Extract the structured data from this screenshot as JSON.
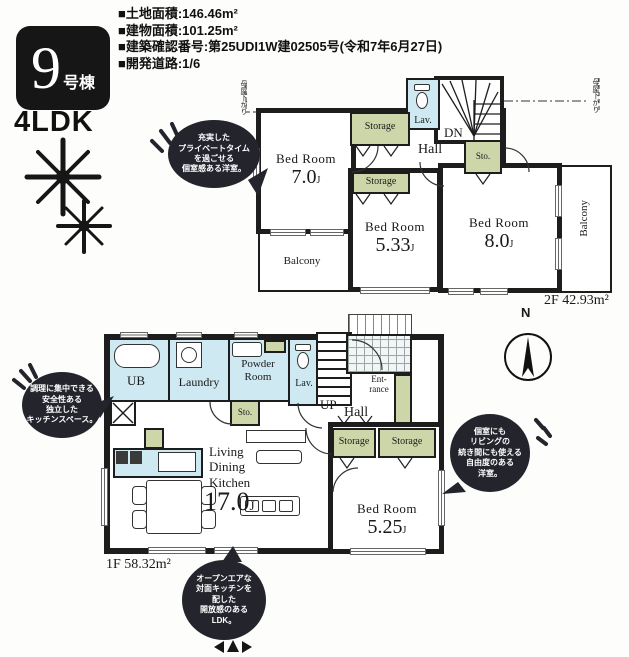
{
  "header": {
    "building_number": "9",
    "building_suffix": "号棟",
    "plan_type": "4LDK",
    "specs": [
      "■土地面積:146.46m²",
      "■建物面積:101.25m²",
      "■建築確認番号:第25UDI1W建02505号(令和7年6月27日)",
      "■開発道路:1/6"
    ]
  },
  "compass": {
    "north_label": "N"
  },
  "floor2": {
    "area_label": "2F 42.93m²",
    "moya_left": "母屋下がり",
    "moya_right": "母屋下がり",
    "rooms": {
      "bed1": {
        "name": "Bed Room",
        "size": "7.0",
        "unit": "J"
      },
      "bed2": {
        "name": "Bed Room",
        "size": "5.33",
        "unit": "J"
      },
      "bed3": {
        "name": "Bed Room",
        "size": "8.0",
        "unit": "J"
      },
      "storage_top": "Storage",
      "storage_mid": "Storage",
      "sto": "Sto.",
      "lav": "Lav.",
      "dn": "DN",
      "hall": "Hall",
      "balcony_left": "Balcony",
      "balcony_right": "Balcony"
    },
    "bubble_private": "充実した\nプライベートタイム\nを過ごせる\n個室感ある洋室。"
  },
  "floor1": {
    "area_label": "1F 58.32m²",
    "rooms": {
      "ub": "UB",
      "laundry": "Laundry",
      "powder": "Powder\nRoom",
      "lav": "Lav.",
      "sto": "Sto.",
      "entrance": "Ent-\nrance",
      "up": "UP",
      "hall": "Hall",
      "storage_a": "Storage",
      "storage_b": "Storage",
      "ldk": {
        "name": "Living\nDining\nKitchen",
        "size": "17.0",
        "unit": "J"
      },
      "bed": {
        "name": "Bed Room",
        "size": "5.25",
        "unit": "J"
      }
    },
    "bubble_kitchen": "調理に集中できる\n安全性ある\n独立した\nキッチンスペース。",
    "bubble_bedroom": "個室にも\nリビングの\n続き間にも使える\n自由度のある\n洋室。",
    "bubble_ldk": "オープンエアな\n対面キッチンを\n配した\n開放感のある\nLDK。"
  }
}
